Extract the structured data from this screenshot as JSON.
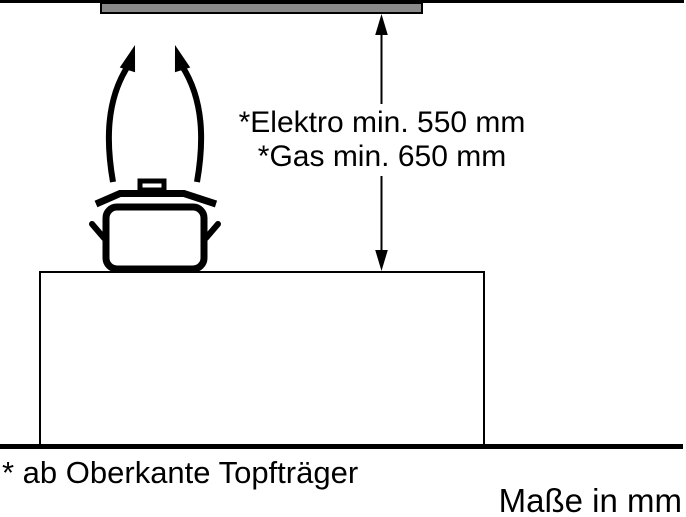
{
  "annotations": {
    "electric_clearance": "*Elektro min. 550 mm",
    "gas_clearance": "*Gas min. 650 mm"
  },
  "footnote": "* ab Oberkante Topfträger",
  "units_note": "Maße in mm",
  "dimensions": {
    "electric_min_mm": 550,
    "gas_min_mm": 650
  },
  "colors": {
    "line": "#000000",
    "hood_fill": "#8a8a8a",
    "background": "#ffffff"
  }
}
